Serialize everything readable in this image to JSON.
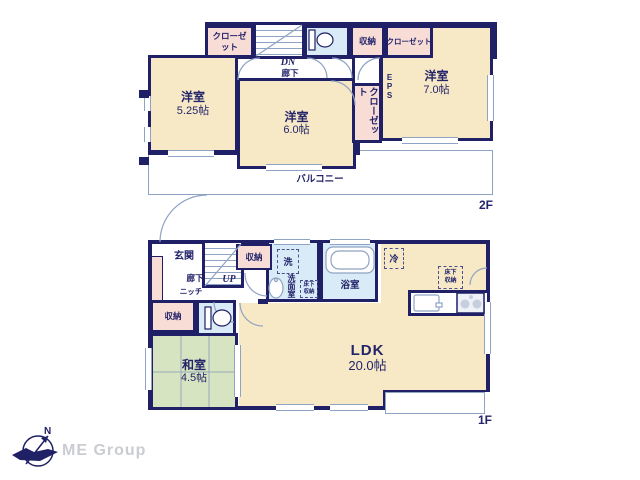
{
  "floor2": {
    "floor_label": "2F",
    "closet_top_left": "クローゼット",
    "stairs_dn": "DN",
    "hallway": "廊下",
    "storage_top": "収納",
    "closet_top_right": "クローゼット",
    "closet_mid": "クローゼット",
    "eps": "EPS",
    "room_a_name": "洋室",
    "room_a_size": "5.25帖",
    "room_b_name": "洋室",
    "room_b_size": "6.0帖",
    "room_c_name": "洋室",
    "room_c_size": "7.0帖",
    "balcony": "バルコニー"
  },
  "floor1": {
    "floor_label": "1F",
    "entrance": "玄関",
    "hallway": "廊下",
    "niche": "ニッチ",
    "stairs_up": "UP",
    "storage_hall": "収納",
    "storage_west": "収納",
    "washer": "洗",
    "washroom": "洗面室",
    "underfloor_wash": "床下収納",
    "underfloor_ldk": "床下収納",
    "bathroom": "浴室",
    "fridge": "冷",
    "tatami_name": "和室",
    "tatami_size": "4.5帖",
    "ldk_name": "LDK",
    "ldk_size": "20.0帖"
  },
  "branding": {
    "company": "ME Group",
    "compass_north": "N"
  },
  "colors": {
    "wall": "#1f2066",
    "room_cream": "#f7e9c6",
    "closet_pink": "#f8dcd6",
    "wet_area_blue": "#d9ebf7",
    "tatami_green": "#d7e4c2",
    "thin_line": "#8fa3c4",
    "text_navy": "#23246a",
    "brand_gray": "#caccd1"
  }
}
